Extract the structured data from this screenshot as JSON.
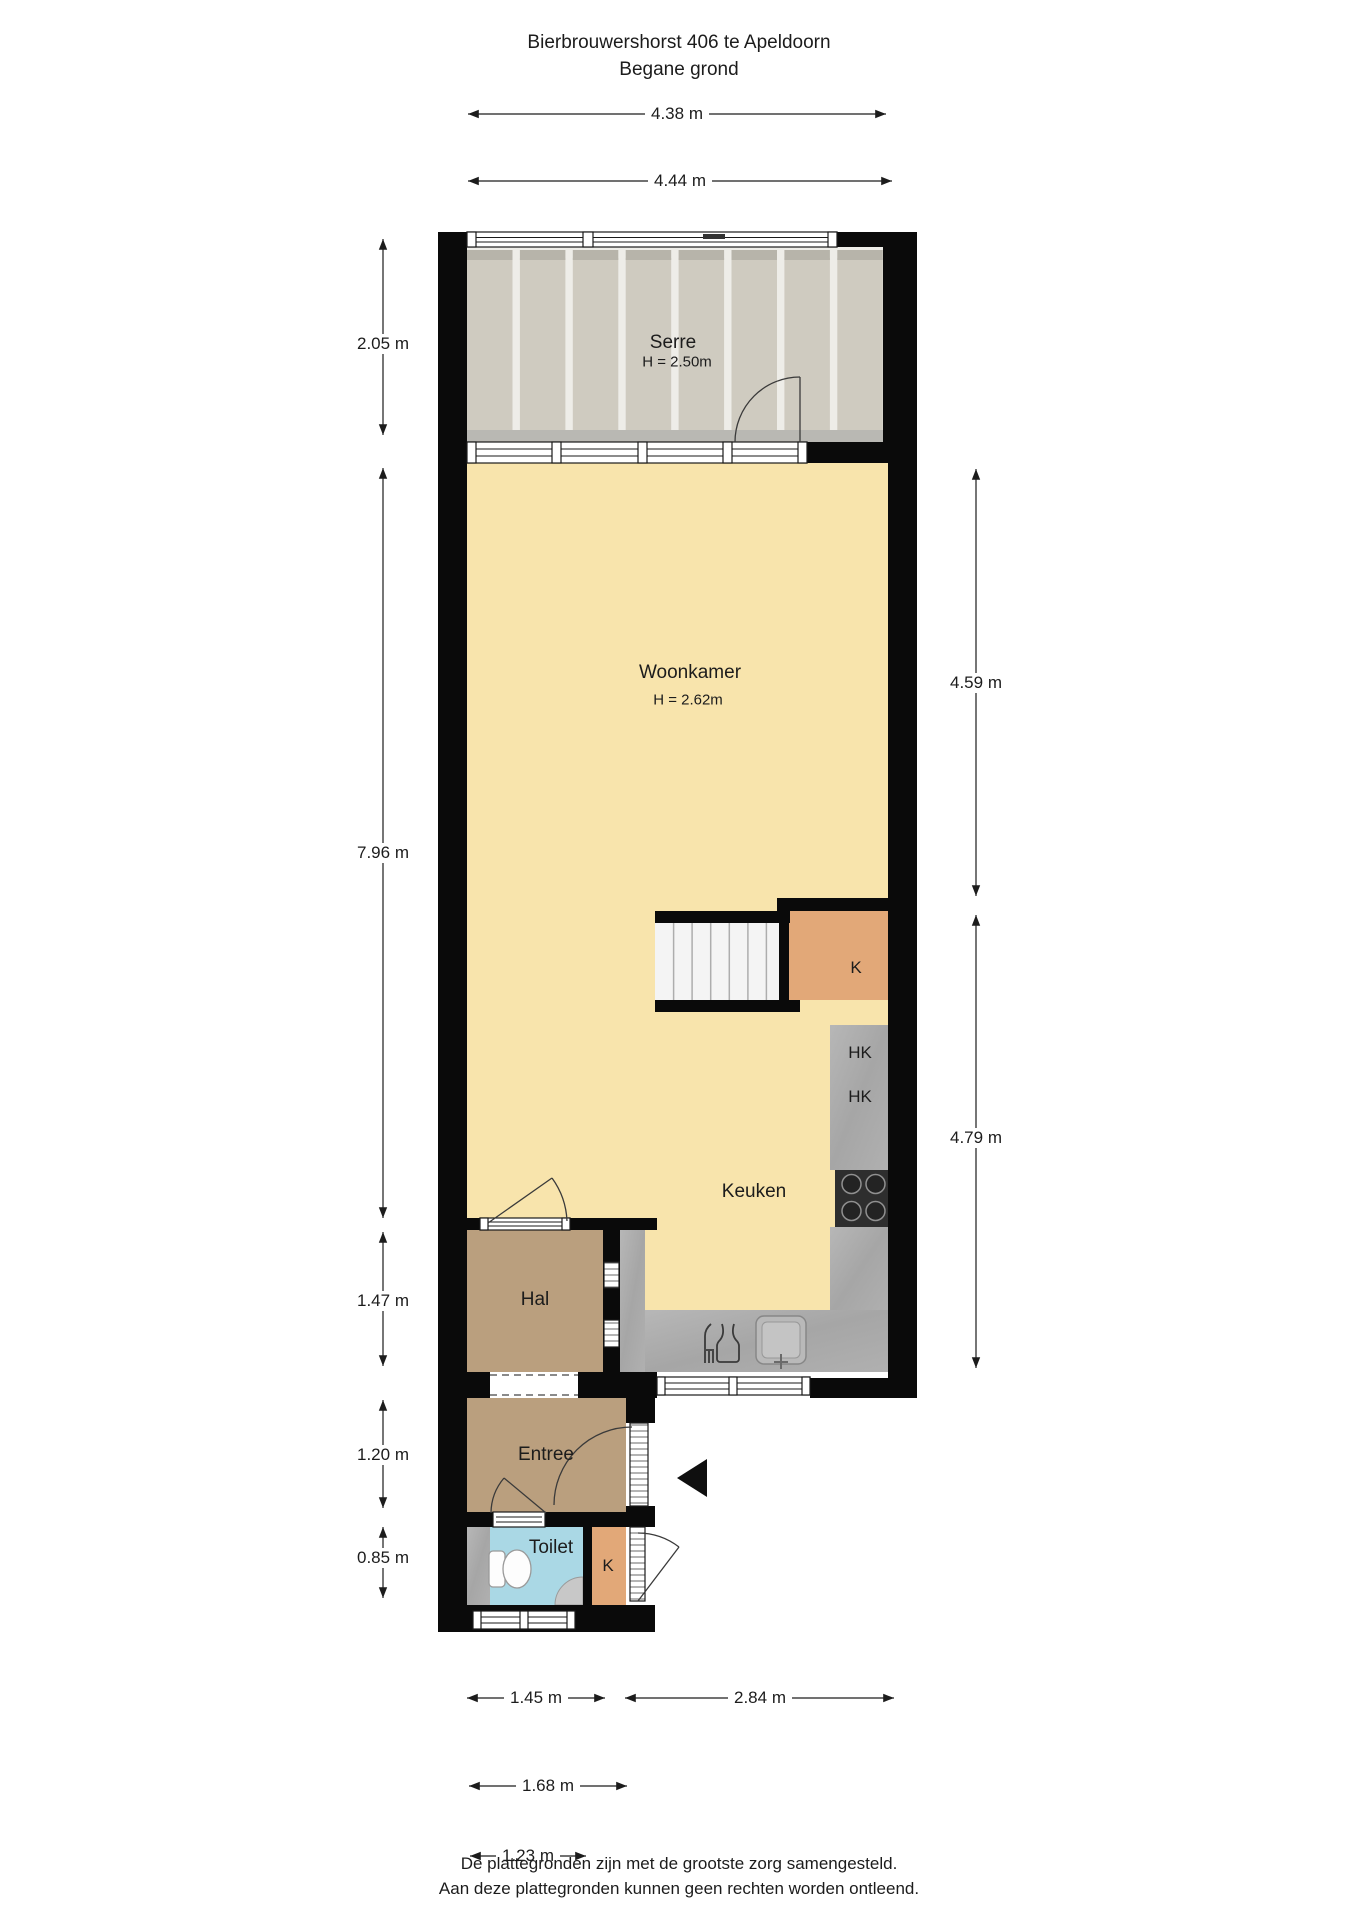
{
  "title": {
    "line1": "Bierbrouwershorst 406 te Apeldoorn",
    "line2": "Begane grond"
  },
  "rooms": {
    "serre": {
      "name": "Serre",
      "height": "H = 2.50m"
    },
    "woonkamer": {
      "name": "Woonkamer",
      "height": "H = 2.62m"
    },
    "keuken": {
      "name": "Keuken"
    },
    "hal": {
      "name": "Hal"
    },
    "entree": {
      "name": "Entree"
    },
    "toilet": {
      "name": "Toilet"
    },
    "closet_k_stairs": {
      "label": "K"
    },
    "closet_k_entry": {
      "label": "K"
    },
    "cupboard_hk_1": {
      "label": "HK"
    },
    "cupboard_hk_2": {
      "label": "HK"
    }
  },
  "dimensions": {
    "top_serre": "4.38 m",
    "top_woonkamer": "4.44 m",
    "left_serre": "2.05 m",
    "left_woonkamer": "7.96 m",
    "left_hal": "1.47 m",
    "left_entree": "1.20 m",
    "left_toilet": "0.85 m",
    "right_woonkamer": "4.59 m",
    "right_keuken": "4.79 m",
    "bottom_toilet": "1.45 m",
    "bottom_keuken": "2.84 m",
    "bottom_entree": "1.68 m",
    "bottom_voordeur": "1.23 m"
  },
  "footer": {
    "line1": "De plattegronden zijn met de grootste zorg samengesteld.",
    "line2": "Aan deze plattegronden kunnen geen rechten worden ontleend."
  },
  "icons": {
    "entrance_arrow": "entrance-direction-triangle"
  },
  "colors": {
    "wall": "#0a0a0a",
    "floor_living": "#F8E4AC",
    "floor_serre": "#CFCBC0",
    "floor_hall": "#BA9F7E",
    "floor_toilet": "#AAD8E5",
    "closet_orange": "#E2A878",
    "counter_gray": "#ABABAB"
  }
}
